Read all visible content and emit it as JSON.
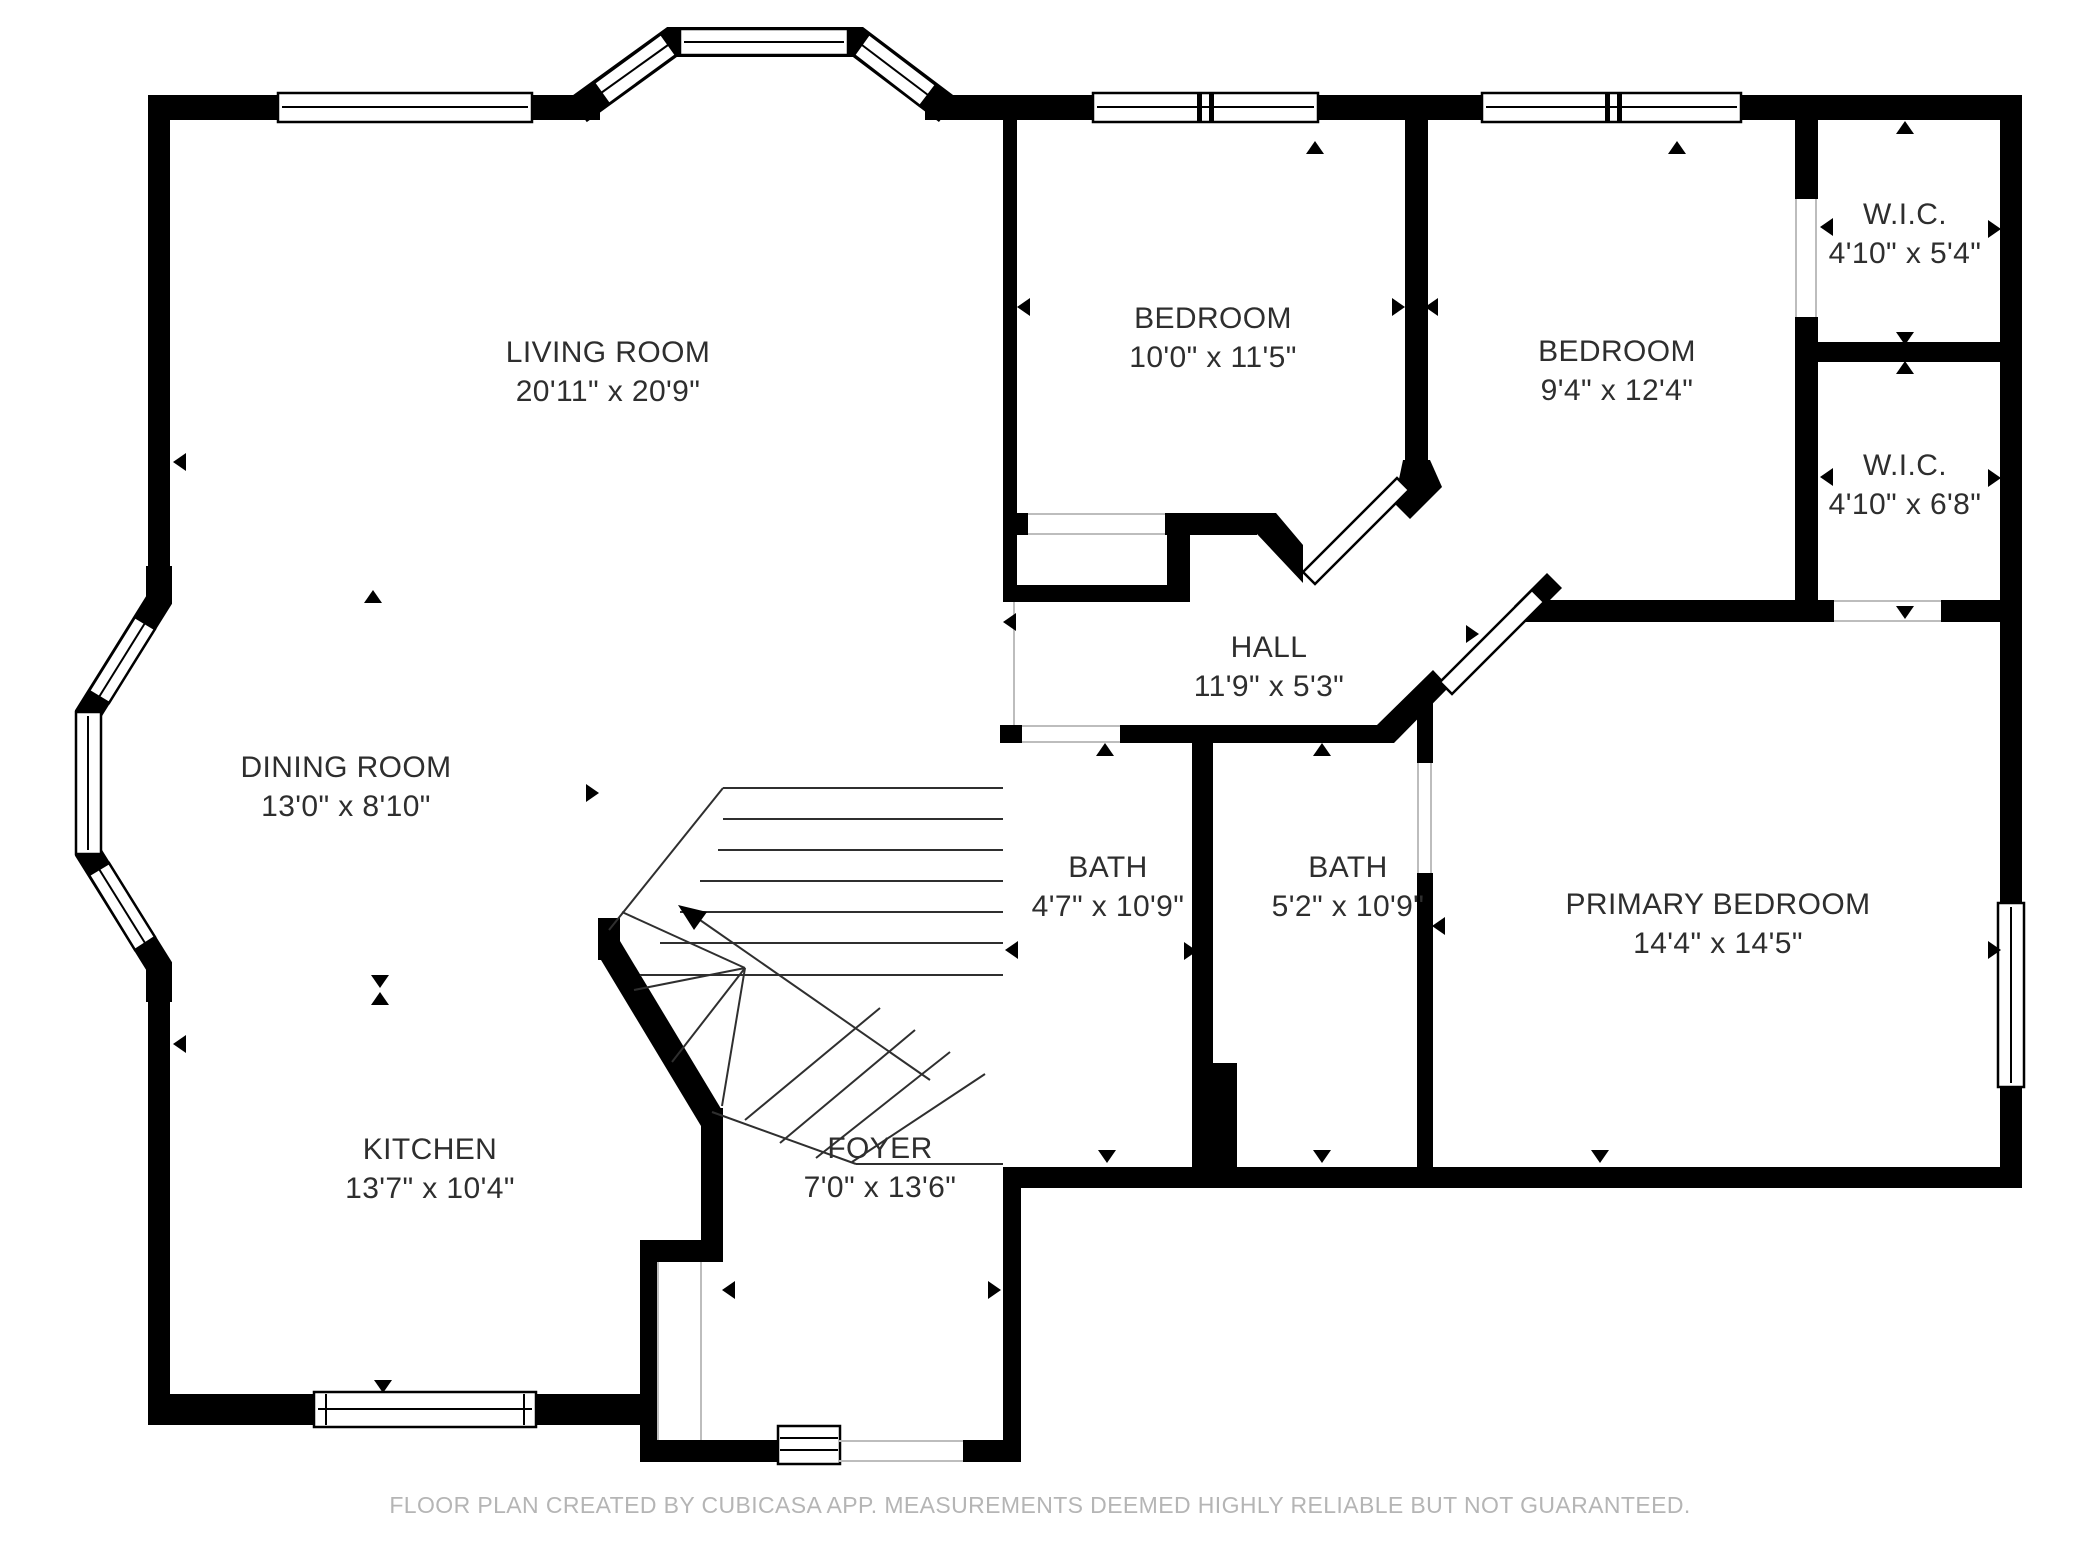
{
  "colors": {
    "wall": "#000000",
    "label_text": "#2e2e2e",
    "footer_text": "#b5b5b5",
    "hairline": "#bdbdbd",
    "stair_line": "#2f2f2f",
    "background": "#ffffff"
  },
  "rooms": [
    {
      "id": "living-room",
      "name": "LIVING ROOM",
      "dims": "20'11\" x 20'9\""
    },
    {
      "id": "dining-room",
      "name": "DINING ROOM",
      "dims": "13'0\" x 8'10\""
    },
    {
      "id": "kitchen",
      "name": "KITCHEN",
      "dims": "13'7\" x 10'4\""
    },
    {
      "id": "foyer",
      "name": "FOYER",
      "dims": "7'0\" x 13'6\""
    },
    {
      "id": "hall",
      "name": "HALL",
      "dims": "11'9\" x 5'3\""
    },
    {
      "id": "bedroom-1",
      "name": "BEDROOM",
      "dims": "10'0\" x 11'5\""
    },
    {
      "id": "bedroom-2",
      "name": "BEDROOM",
      "dims": "9'4\" x 12'4\""
    },
    {
      "id": "wic-1",
      "name": "W.I.C.",
      "dims": "4'10\" x 5'4\""
    },
    {
      "id": "wic-2",
      "name": "W.I.C.",
      "dims": "4'10\" x 6'8\""
    },
    {
      "id": "bath-1",
      "name": "BATH",
      "dims": "4'7\" x 10'9\""
    },
    {
      "id": "bath-2",
      "name": "BATH",
      "dims": "5'2\" x 10'9\""
    },
    {
      "id": "primary-bedroom",
      "name": "PRIMARY BEDROOM",
      "dims": "14'4\" x 14'5\""
    }
  ],
  "footer": {
    "disclaimer": "FLOOR PLAN CREATED BY CUBICASA APP. MEASUREMENTS DEEMED HIGHLY RELIABLE BUT NOT GUARANTEED."
  }
}
